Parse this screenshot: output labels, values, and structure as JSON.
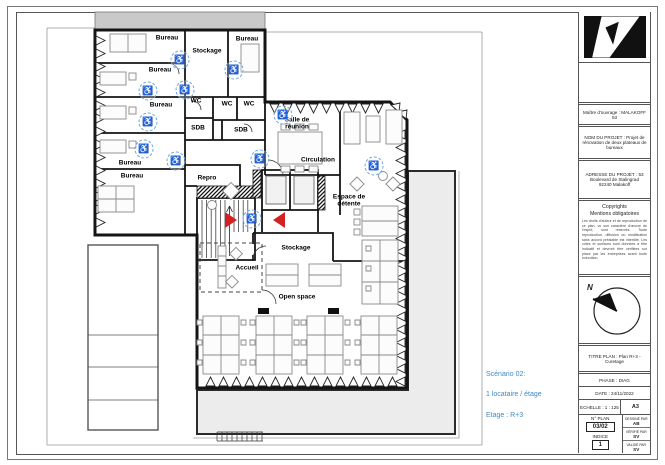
{
  "plan": {
    "wheelchair_glyph": "♿",
    "rooms": [
      {
        "label": "Bureau"
      },
      {
        "label": "Bureau"
      },
      {
        "label": "Stockage"
      },
      {
        "label": "Bureau"
      },
      {
        "label": "Bureau"
      },
      {
        "label": "Bureau"
      },
      {
        "label": "Bureau"
      },
      {
        "label": "WC"
      },
      {
        "label": "WC"
      },
      {
        "label": "WC"
      },
      {
        "label": "SDB"
      },
      {
        "label": "SDB"
      },
      {
        "label": "Salle de\nréunion"
      },
      {
        "label": "Circulation"
      },
      {
        "label": "Repro"
      },
      {
        "label": "Espace de\ndétente"
      },
      {
        "label": "Stockage"
      },
      {
        "label": "Accueil"
      },
      {
        "label": "Open space"
      }
    ]
  },
  "scenario": {
    "line1": "Scénario 02:",
    "line2": "1 locataire / étage",
    "line3": "Etage : R+3"
  },
  "title_block": {
    "owner": "Maître d'ouvrage : MALAKOFF 53",
    "project": "NOM DU PROJET : Projet de\nrénovation de deux plateaux de\nbureaux",
    "address": "ADRESSE DU PROJET : 53\nBoulevard de Stalingrad\n92240 Malakoff",
    "copyright_title": "Copyrights",
    "copyright_subtitle": "Mentions obligatoires",
    "copyright_body": "Les droits d'auteur et de reproduction de ce plan, vu son caractère d'œuvre de l'esprit, sont réservés. Toute reproduction, diffusion ou modification sans accord préalable est interdite. Les cotes et surfaces sont données à titre indicatif et devront être vérifiées sur place par les entreprises avant toute exécution.",
    "north_label": "N",
    "titre_plan": "TITRE PLAN : Plan R+3 - Curetage",
    "phase": "PHASE : DIAG",
    "date": "DATE : 24/11/2022",
    "echelle": "ECHELLE : 1 : 125",
    "format": "A3",
    "n_plan_label": "N° PLAN",
    "n_plan_value": "03/02",
    "indice_label": "INDICE",
    "indice_value": "1",
    "drawn_label": "DESSINÉ PAR",
    "drawn_value": "AB",
    "checked_label": "VÉRIFIÉ PAR",
    "checked_value": "SV",
    "approved_label": "VALIDÉ PAR",
    "approved_value": "SV"
  },
  "colors": {
    "wall": "#141414",
    "terrace_fill": "#ececec",
    "neighbor_band": "#c9c9c9",
    "marker_red": "#d42020",
    "accent_blue": "#3f88c5",
    "wheelchair_blue": "#0d3a66"
  }
}
